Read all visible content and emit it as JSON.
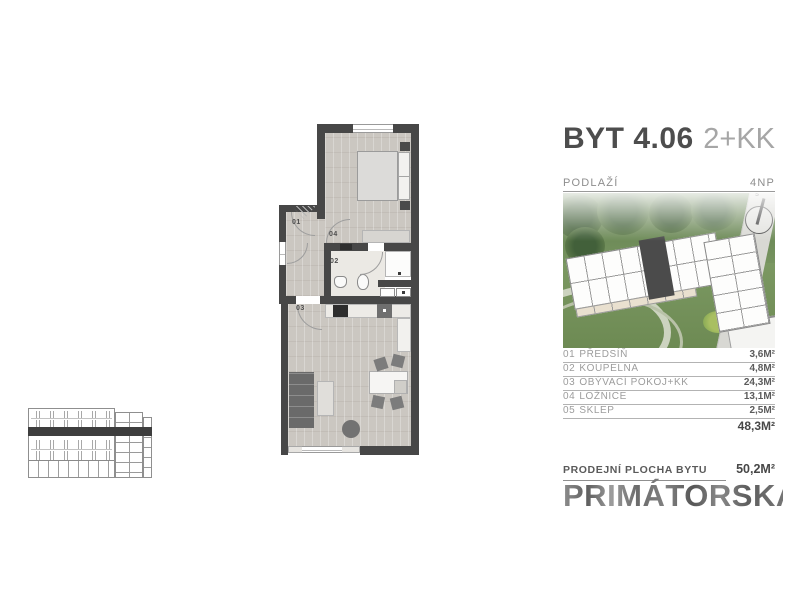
{
  "header": {
    "unit_label": "BYT 4.06",
    "layout_label": "2+KK"
  },
  "floor": {
    "label": "PODLAŽÍ",
    "value": "4NP"
  },
  "rooms": [
    {
      "num": "01",
      "name": "PŘEDSÍŇ",
      "area": "3,6M²"
    },
    {
      "num": "02",
      "name": "KOUPELNA",
      "area": "4,8M²"
    },
    {
      "num": "03",
      "name": "OBÝVACÍ POKOJ+KK",
      "area": "24,3M²"
    },
    {
      "num": "04",
      "name": "LOŽNICE",
      "area": "13,1M²"
    },
    {
      "num": "05",
      "name": "SKLEP",
      "area": "2,5M²"
    }
  ],
  "total_area": "48,3M²",
  "sale": {
    "label": "PRODEJNÍ PLOCHA BYTU",
    "value": "50,2M²"
  },
  "brand": "PRIMÁTORSKÁ",
  "site_plan": {
    "north_label": "S"
  },
  "plan": {
    "labels": {
      "hall": "01",
      "bath": "02",
      "living": "03",
      "bedroom": "04"
    }
  },
  "colors": {
    "wall": "#474747",
    "wood": "#cbc7c1",
    "tile": "#ebe9e4",
    "highlight_unit": "#4b4b4b",
    "grass": "#7d9a64",
    "band": "#3e3e3e",
    "heading": "#4d4d4d",
    "muted": "#9c9c9c"
  }
}
